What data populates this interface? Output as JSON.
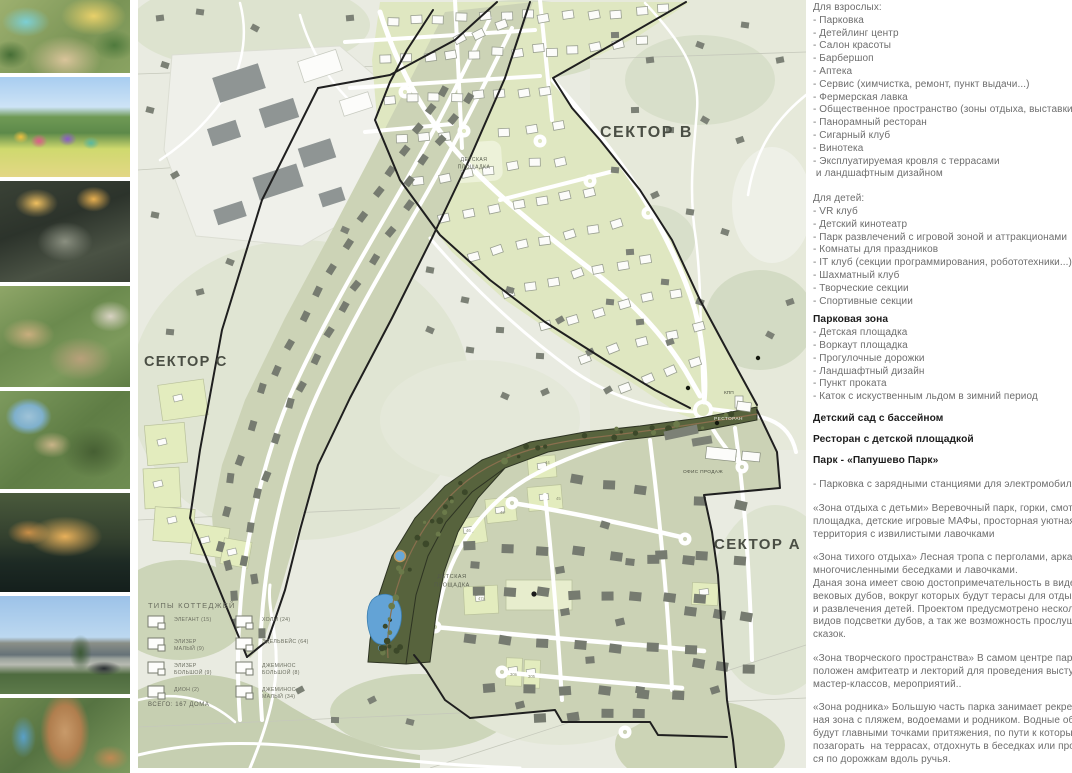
{
  "sidebar": {
    "photos": [
      {
        "alt": "aerial-playground-render"
      },
      {
        "alt": "colorful-kids-playground-render"
      },
      {
        "alt": "night-park-stairs-render"
      },
      {
        "alt": "amphitheater-terraces-render"
      },
      {
        "alt": "aerial-forest-pond-render"
      },
      {
        "alt": "evening-deck-over-water-render"
      },
      {
        "alt": "sales-office-building-render"
      },
      {
        "alt": "wooden-tower-slide-render"
      }
    ]
  },
  "map": {
    "sector_b": "СЕКТОР B",
    "sector_c": "СЕКТОР C",
    "sector_a": "СЕКТОР A",
    "labels": {
      "playground1_l1": "ДЕТСКАЯ",
      "playground1_l2": "ПЛОЩАДКА",
      "playground2_l1": "ДЕТСКАЯ",
      "playground2_l2": "ПЛОЩАДКА",
      "kpp": "КПП",
      "restaurant": "РЕСТОРАН",
      "sales_office": "ОФИС ПРОДАЖ"
    },
    "parcel_numbers": [
      "42",
      "44",
      "45",
      "46",
      "47а",
      "30в",
      "305"
    ],
    "legend": {
      "title": "ТИПЫ КОТТЕДЖЕЙ",
      "items_left": [
        "ЭЛЕГАНТ (15)",
        "ЭЛИЗЕР МАЛЫЙ (9)",
        "ЭЛИЗЕР БОЛЬШОЙ (9)",
        "ДИОН (2)"
      ],
      "items_right": [
        "ХОЛМ (24)",
        "ЭДЕЛЬВЕЙС (64)",
        "ДЖЕМИНОС БОЛЬШОЙ (8)",
        "ДЖЕМИНОС МАЛЫЙ (34)"
      ],
      "total": "ВСЕГО: 167 ДОМА"
    },
    "colors": {
      "new_parcel_green": "#dfe7c1",
      "existing_parcel_sage": "#cbd2b5",
      "park_dark_green": "#57633d",
      "water_blue": "#63a3d6",
      "boundary_black": "#1f1f1f"
    }
  },
  "panel": {
    "blocks": [
      {
        "style": "normal",
        "gap": 12,
        "text": "Для взрослых:\n- Парковка\n- Детейлинг центр\n- Салон красоты\n- Барбершоп\n- Аптека\n- Сервис (химчистка, ремонт, пункт выдачи...)\n- Фермерская лавка\n- Общественное пространство (зоны отдыха, выставки.\n- Панорамный ресторан\n- Сигарный клуб\n- Винотека\n- Эксплуатируемая кровля с террасами\n и ландшафтным дизайном"
      },
      {
        "style": "normal",
        "gap": 6,
        "text": "Для детей:\n- VR клуб\n- Детский кинотеатр\n- Парк развлечений с игровой зоной и аттракционами\n- Комнаты для праздников\n- IT клуб (секции программирования, робототехники...)\n- Шахматный клуб\n- Творческие секции\n- Спортивные секции"
      },
      {
        "style": "bold",
        "gap": 0,
        "text": "Парковая зона"
      },
      {
        "style": "normal",
        "gap": 9,
        "text": "- Детская площадка\n- Воркаут площадка\n- Прогулочные дорожки\n- Ландшафтный дизайн\n- Пункт проката\n- Каток с искуственным льдом в зимний период"
      },
      {
        "style": "bold",
        "gap": 8,
        "text": "Детский сад с бассейном"
      },
      {
        "style": "bold",
        "gap": 8,
        "text": "Ресторан с детской площадкой"
      },
      {
        "style": "bold",
        "gap": 12,
        "text": "Парк - «Папушево Парк»"
      },
      {
        "style": "normal",
        "gap": 11,
        "text": "- Парковка с зарядными станциями для электромобиля"
      },
      {
        "style": "normal",
        "gap": 11,
        "text": "«Зона отдыха с детьми» Веревочный парк, горки, смотровая\nплощадка, детские игровые МАФы, просторная уютная\nтерритория с извилистыми лавочками"
      },
      {
        "style": "normal",
        "gap": 11,
        "text": "«Зона тихого отдыха» Лесная тропа с перголами, арками,\nмногочисленными беседками и лавочками.\nДаная зона имеет свою достопримечательность в виде\nвековых дубов, вокруг которых будут терасы для отдыха\nи развлечения детей. Проектом предусмотрено несколько\nвидов подсветки дубов, а так же возможность прослушать\nсказок."
      },
      {
        "style": "normal",
        "gap": 11,
        "text": "«Зона творческого пространства» В самом центре парка рас\nположен амфитеатр и лекторий для проведения выступлений\nмастер-классов, мероприятий.."
      },
      {
        "style": "normal",
        "gap": 11,
        "text": "«Зона родника» Большую часть парка занимает рекреацион\nная зона с пляжем, водоемами и родником. Водные объекты\nбудут главными точками притяжения, по пути к которым\nпозагорать  на террасах, отдохнуть в беседках или прогулять\nся по дорожкам вдоль ручья."
      }
    ]
  }
}
